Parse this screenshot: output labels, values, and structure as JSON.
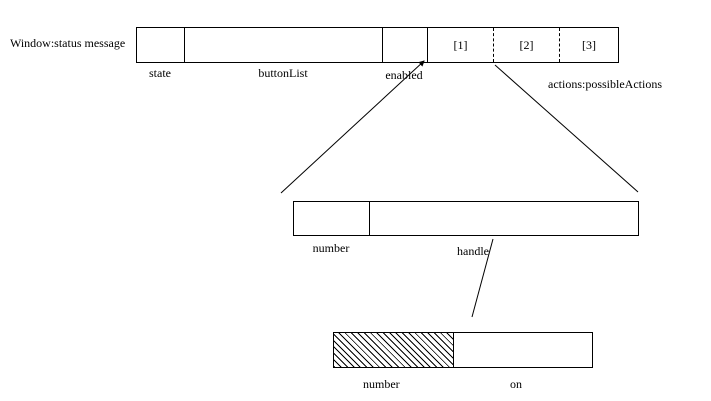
{
  "window_object": {
    "title": "Window:status message",
    "action_cells": [
      "[1]",
      "[2]",
      "[3]"
    ],
    "labels": {
      "state": "state",
      "button_list": "buttonList",
      "enabled": "enabled",
      "actions": "actions:possibleActions"
    }
  },
  "middle_object": {
    "labels": {
      "number": "number",
      "handle": "handle"
    }
  },
  "bottom_object": {
    "labels": {
      "number": "number",
      "on": "on"
    }
  },
  "colors": {
    "background": "#ffffff",
    "line": "#000000"
  }
}
